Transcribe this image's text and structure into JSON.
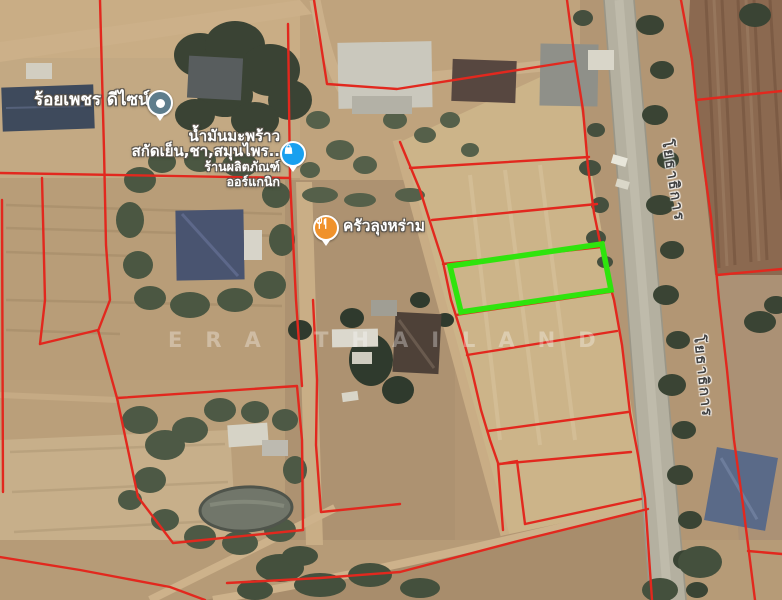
{
  "map": {
    "watermark": "ERA THAILAND",
    "pois": [
      {
        "id": "design-shop",
        "label": "ร้อยเพชร ดีไซน์",
        "pin": "dot",
        "pin_color": "#5E7D8C"
      },
      {
        "id": "coconut-oil-shop",
        "label_line1": "น้ำมันมะพร้าว",
        "label_line2": "สกัดเย็น,ชา,สมุนไพร..",
        "sub_line1": "ร้านผลิตภัณฑ์",
        "sub_line2": "ออร์แกนิก",
        "pin": "shopping-bag",
        "pin_color": "#18A0EF"
      },
      {
        "id": "restaurant",
        "label": "ครัวลุงหร่าม",
        "pin": "restaurant",
        "pin_color": "#F0922B"
      }
    ],
    "road_labels": [
      {
        "text": "โยธาธิการ"
      },
      {
        "text": "โยธาธิการ"
      }
    ]
  },
  "overlay": {
    "boundary_color": "#E2281E",
    "highlight_color": "#2FE40D",
    "highlight_plot": {
      "points": [
        [
          450,
          266
        ],
        [
          602,
          244
        ],
        [
          611,
          290
        ],
        [
          461,
          312
        ]
      ]
    },
    "parcel_lines": [
      {
        "points": [
          [
            100,
            0
          ],
          [
            104,
            150
          ],
          [
            106,
            245
          ],
          [
            110,
            300
          ],
          [
            98,
            331
          ]
        ]
      },
      {
        "points": [
          [
            0,
            173
          ],
          [
            290,
            178
          ]
        ]
      },
      {
        "points": [
          [
            42,
            178
          ],
          [
            45,
            300
          ],
          [
            40,
            344
          ]
        ]
      },
      {
        "points": [
          [
            40,
            344
          ],
          [
            98,
            330
          ],
          [
            117,
            398
          ]
        ]
      },
      {
        "points": [
          [
            2,
            200
          ],
          [
            3,
            492
          ]
        ]
      },
      {
        "points": [
          [
            288,
            24
          ],
          [
            290,
            178
          ],
          [
            296,
            300
          ],
          [
            302,
            386
          ]
        ]
      },
      {
        "points": [
          [
            314,
            0
          ],
          [
            327,
            84
          ],
          [
            397,
            89
          ],
          [
            575,
            61
          ]
        ]
      },
      {
        "points": [
          [
            567,
            0
          ],
          [
            575,
            60
          ],
          [
            583,
            110
          ],
          [
            588,
            167
          ],
          [
            594,
            213
          ],
          [
            601,
            247
          ],
          [
            608,
            278
          ],
          [
            614,
            300
          ],
          [
            622,
            345
          ],
          [
            630,
            413
          ],
          [
            638,
            455
          ],
          [
            645,
            498
          ],
          [
            652,
            600
          ]
        ]
      },
      {
        "points": [
          [
            681,
            0
          ],
          [
            692,
            60
          ],
          [
            696,
            100
          ],
          [
            703,
            160
          ],
          [
            711,
            217
          ],
          [
            719,
            300
          ],
          [
            727,
            370
          ],
          [
            734,
            440
          ],
          [
            743,
            505
          ],
          [
            755,
            600
          ]
        ]
      },
      {
        "points": [
          [
            696,
            100
          ],
          [
            782,
            91
          ]
        ]
      },
      {
        "points": [
          [
            717,
            275
          ],
          [
            782,
            269
          ]
        ]
      },
      {
        "points": [
          [
            748,
            551
          ],
          [
            782,
            554
          ]
        ]
      },
      {
        "points": [
          [
            400,
            142
          ],
          [
            420,
            190
          ],
          [
            432,
            228
          ],
          [
            443,
            262
          ],
          [
            451,
            300
          ],
          [
            462,
            335
          ],
          [
            471,
            367
          ],
          [
            481,
            410
          ],
          [
            490,
            440
          ],
          [
            498,
            463
          ],
          [
            503,
            530
          ]
        ]
      },
      {
        "points": [
          [
            500,
            464
          ],
          [
            517,
            461
          ],
          [
            525,
            524
          ]
        ]
      },
      {
        "points": [
          [
            410,
            168
          ],
          [
            589,
            157
          ]
        ]
      },
      {
        "points": [
          [
            432,
            220
          ],
          [
            597,
            204
          ]
        ]
      },
      {
        "points": [
          [
            443,
            264
          ],
          [
            601,
            247
          ]
        ]
      },
      {
        "points": [
          [
            456,
            315
          ],
          [
            610,
            292
          ]
        ]
      },
      {
        "points": [
          [
            467,
            355
          ],
          [
            617,
            331
          ]
        ]
      },
      {
        "points": [
          [
            488,
            431
          ],
          [
            628,
            412
          ]
        ]
      },
      {
        "points": [
          [
            499,
            464
          ],
          [
            631,
            452
          ]
        ]
      },
      {
        "points": [
          [
            525,
            524
          ],
          [
            641,
            499
          ]
        ]
      },
      {
        "points": [
          [
            117,
            398
          ],
          [
            297,
            386
          ],
          [
            302,
            440
          ],
          [
            303,
            530
          ],
          [
            173,
            543
          ],
          [
            138,
            497
          ],
          [
            117,
            398
          ]
        ]
      },
      {
        "points": [
          [
            313,
            300
          ],
          [
            317,
            380
          ],
          [
            316,
            445
          ],
          [
            321,
            512
          ],
          [
            400,
            504
          ]
        ]
      },
      {
        "points": [
          [
            0,
            557
          ],
          [
            80,
            570
          ],
          [
            170,
            587
          ],
          [
            205,
            600
          ]
        ]
      },
      {
        "points": [
          [
            227,
            583
          ],
          [
            320,
            578
          ],
          [
            400,
            572
          ],
          [
            518,
            541
          ],
          [
            648,
            509
          ]
        ]
      }
    ]
  }
}
